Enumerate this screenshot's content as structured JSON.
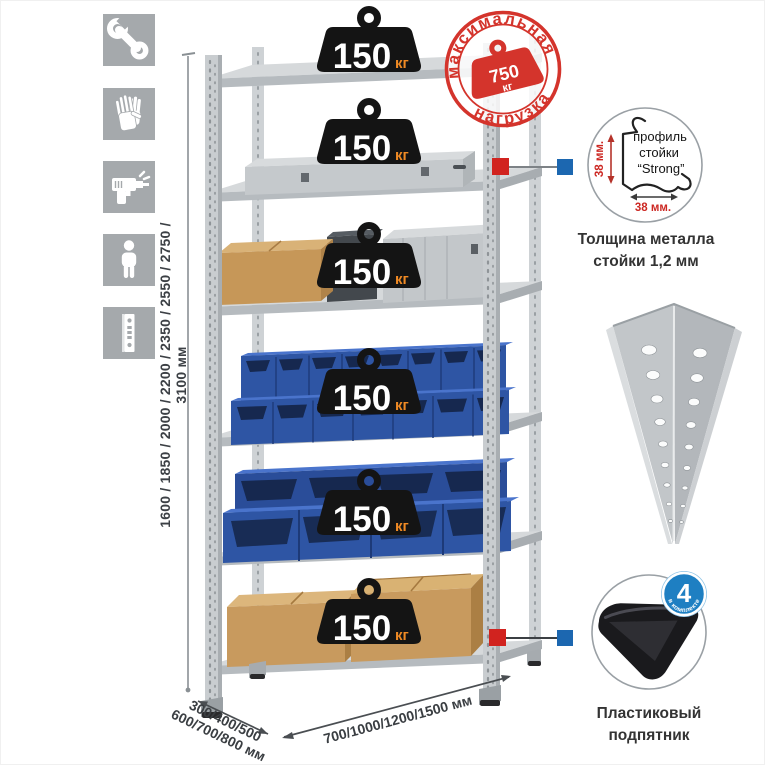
{
  "image": {
    "type": "product-infographic",
    "subject": "metal shelving rack"
  },
  "colors": {
    "stamp_red": "#d4342c",
    "badge_blue": "#1e7fc2",
    "bin_blue": "#2e55a4",
    "connector_red": "#d1231f",
    "connector_blue": "#1c67b0",
    "icon_bg": "#a5a9ac",
    "metal_gray": "#c9cdd0",
    "load_unit_orange": "#f08a24"
  },
  "feature_icons": [
    {
      "name": "wrench-icon"
    },
    {
      "name": "gloves-icon"
    },
    {
      "name": "drill-icon"
    },
    {
      "name": "person-icon"
    },
    {
      "name": "upright-profile-icon"
    }
  ],
  "rack": {
    "shelf_count": 6,
    "shelf_load_value": "150",
    "shelf_load_unit": "кг"
  },
  "max_load_stamp": {
    "arc_top": "максимальная",
    "arc_bottom": "нагрузка",
    "value": "750",
    "unit": "кг"
  },
  "height_dimension": {
    "label": "1600 / 1850 / 2000 / 2200 / 2350 / 2550 / 2750 / 3100 мм"
  },
  "depth_dimension": {
    "line1": "300/400/500",
    "line2": "600/700/800 мм"
  },
  "width_dimension": {
    "label": "700/1000/1200/1500 мм"
  },
  "profile_detail": {
    "text_line1": "профиль",
    "text_line2": "стойки",
    "text_line3": "“Strong”",
    "vertical_dim": "38 мм.",
    "horizontal_dim": "38 мм.",
    "caption_line1": "Толщина металла",
    "caption_line2": "стойки 1,2 мм"
  },
  "foot_detail": {
    "badge_value": "4",
    "badge_arc": "в комплекте",
    "caption_line1": "Пластиковый",
    "caption_line2": "подпятник"
  }
}
